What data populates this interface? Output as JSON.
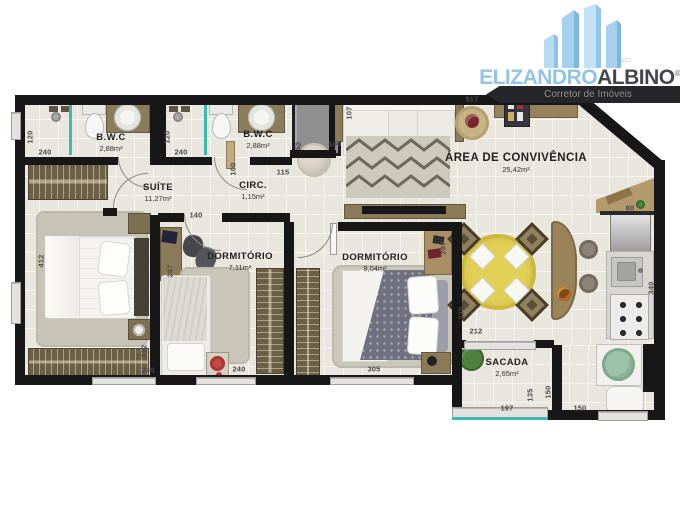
{
  "logo": {
    "brand_primary": "ELIZANDRO",
    "brand_secondary": "ALBINO",
    "registered_mark": "®",
    "creci": "CRECI",
    "tagline": "Corretor de Imóveis"
  },
  "rooms": [
    {
      "name": "B.W.C",
      "area": "2,88m²"
    },
    {
      "name": "B.W.C",
      "area": "2,88m²"
    },
    {
      "name": "SUÍTE",
      "area": "11,27m²"
    },
    {
      "name": "CIRC.",
      "area": "1,15m²"
    },
    {
      "name": "DORMITÓRIO",
      "area": "7,11m²"
    },
    {
      "name": "DORMITÓRIO",
      "area": "9,04m²"
    },
    {
      "name": "ÁREA DE CONVIVÊNCIA",
      "area": "25,42m²"
    },
    {
      "name": "SACADA",
      "area": "2,65m²"
    }
  ],
  "dimensions_cm": [
    "120",
    "240",
    "120",
    "240",
    "100",
    "115",
    "52",
    "100",
    "140",
    "107",
    "517",
    "80",
    "340",
    "412",
    "312",
    "240",
    "297",
    "240",
    "297",
    "305",
    "225",
    "212",
    "135",
    "150",
    "197",
    "150"
  ],
  "colors": {
    "wall": "#171717",
    "floor": "#e9e6dd",
    "wood_dark": "#6b5f46",
    "wood_counter": "#8b7c5b",
    "glass_teal": "#3fb7b2",
    "table_yellow": "#e2cf55",
    "tank_green": "#9cc2a9",
    "accent_red": "#a93734",
    "brand_blue": "#92c4e9",
    "brand_dark": "#45454f",
    "ribbon_dark": "#25252b"
  }
}
